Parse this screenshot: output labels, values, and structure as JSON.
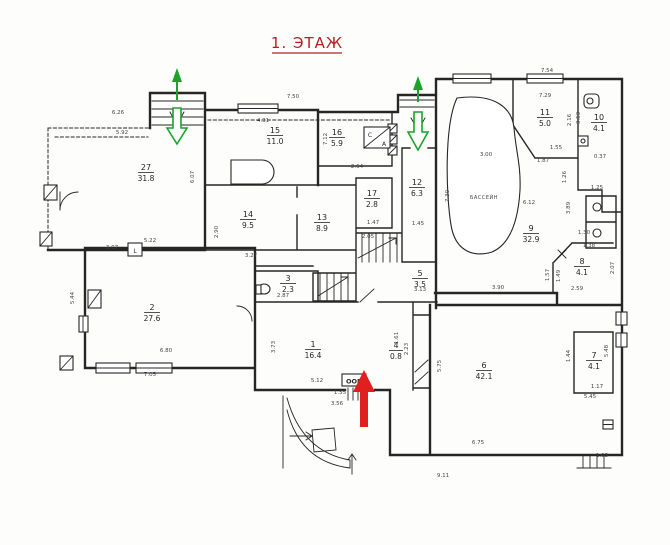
{
  "title": {
    "text": "1. ЭТАЖ"
  },
  "annotations": {
    "pool": "БАССЕЙН",
    "entry_box": "ООВ",
    "compass_c": "С",
    "compass_a": "А",
    "stove_mark": "L"
  },
  "rooms": [
    {
      "number": "27",
      "area": "31.8"
    },
    {
      "number": "15",
      "area": "11.0"
    },
    {
      "number": "16",
      "area": "5.9"
    },
    {
      "number": "14",
      "area": "9.5"
    },
    {
      "number": "13",
      "area": "8.9"
    },
    {
      "number": "17",
      "area": "2.8"
    },
    {
      "number": "12",
      "area": "6.3"
    },
    {
      "number": "11",
      "area": "5.0"
    },
    {
      "number": "10",
      "area": "4.1"
    },
    {
      "number": "9",
      "area": "32.9"
    },
    {
      "number": "8",
      "area": "4.1"
    },
    {
      "number": "2",
      "area": "27.6"
    },
    {
      "number": "3",
      "area": "2.3"
    },
    {
      "number": "5",
      "area": "3.5"
    },
    {
      "number": "1",
      "area": "16.4"
    },
    {
      "number": "4",
      "area": "0.8"
    },
    {
      "number": "6",
      "area": "42.1"
    },
    {
      "number": "7",
      "area": "4.1"
    }
  ],
  "dims": [
    "6.26",
    "5.92",
    "7.50",
    "4.31",
    "7.54",
    "7.29",
    "3.00",
    "6.12",
    "2.64",
    "1.45",
    "7.30",
    "7.12",
    "2.90",
    "3.27",
    "5.22",
    "3.07",
    "5.44",
    "6.80",
    "7.05",
    "2.87",
    "5.12",
    "3.56",
    "3.13",
    "2.59",
    "3.90",
    "1.57",
    "1.49",
    "1.30",
    "1.38",
    "1.55",
    "1.87",
    "2.16",
    "3.53",
    "0.37",
    "1.26",
    "1.25",
    "3.89",
    "5.75",
    "5.48",
    "6.75",
    "9.11",
    "1.17",
    "1.03",
    "1.61",
    "2.23",
    "3.73",
    "1.47",
    "2.05",
    "1.55",
    "2.07",
    "1.44",
    "5.45",
    "6.07"
  ],
  "colors": {
    "paper": "#fdfdfb",
    "ink": "#262626",
    "dim_ink": "#454545",
    "title_red": "#b22222",
    "arrow_red": "#e01f1f",
    "arrow_green": "#1ca32b"
  }
}
